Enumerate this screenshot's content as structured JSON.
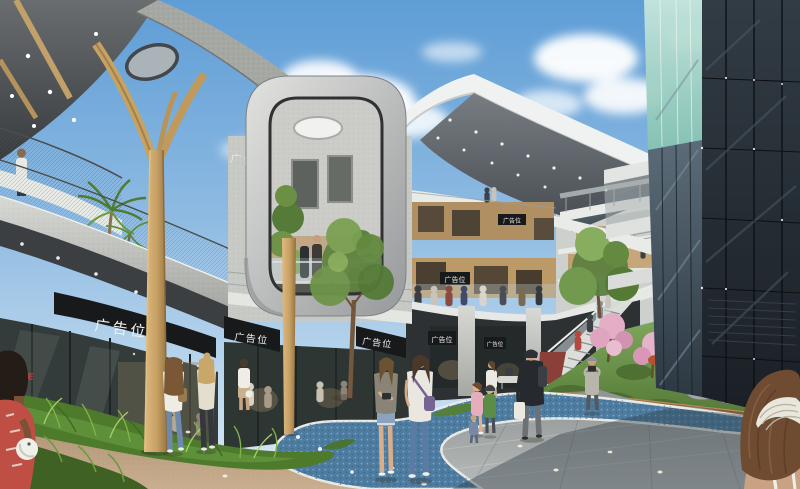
{
  "signs": {
    "ad_label": "广告位",
    "sale_label": "SALE"
  },
  "palette": {
    "sky_top": "#5e9dd6",
    "sky_mid": "#8fbbe2",
    "sky_horizon": "#dcebf5",
    "cloud": "#ffffff",
    "canopy_dark": "#3f4245",
    "fascia_speckle": "#a5a7a3",
    "concrete_light": "#d5d6d2",
    "concrete_mid": "#a9aba7",
    "wood_light": "#d2ab6e",
    "wood_dark": "#9c7843",
    "frame_light": "#e2e3e0",
    "frame_dark": "#96989a",
    "tower_top": "#323c44",
    "tower_bottom": "#191f25",
    "glass_green": "#a8d8cb",
    "copper_base": "#7a5434",
    "path_blue": "#4d7ca0",
    "path_edge": "#e9eae6",
    "paving_warm": "#b59a7c",
    "paving_grey": "#a3a8a9",
    "ground_shadow": "#333e47",
    "foliage_dark": "#4e7a2c",
    "foliage_light": "#7fb24a",
    "blossom_pink": "#e3aec6",
    "sign_bg": "#17191b",
    "sign_text": "#f0f1ef",
    "sale_red": "#c23b3c"
  }
}
